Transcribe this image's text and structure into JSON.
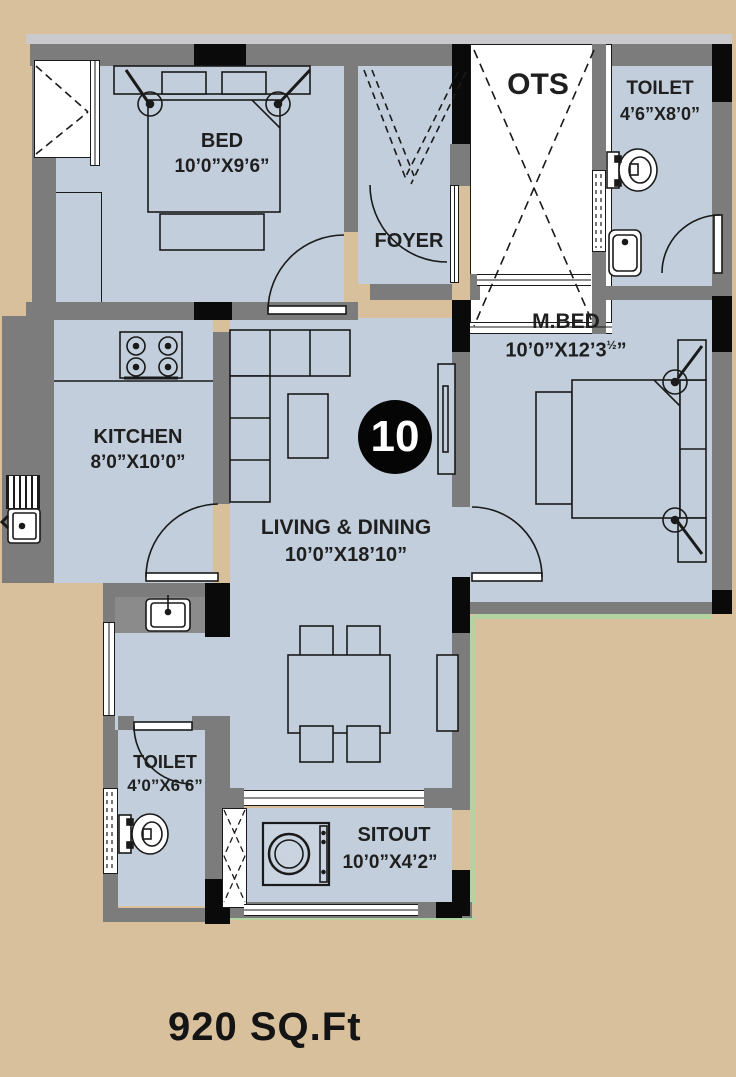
{
  "plan": {
    "unit_number": "10",
    "area_label": "920 SQ.Ft",
    "rooms": {
      "bed": {
        "name": "BED",
        "dim": "10’0”X9’6”"
      },
      "foyer": {
        "name": "FOYER"
      },
      "ots": {
        "name": "OTS"
      },
      "toilet_top": {
        "name": "TOILET",
        "dim": "4’6”X8’0”"
      },
      "master_bed": {
        "name": "M.BED",
        "dim_main": "10’0”X12’3",
        "dim_frac": "½",
        "dim_suffix": "”"
      },
      "kitchen": {
        "name": "KITCHEN",
        "dim": "8’0”X10’0”"
      },
      "living_dining": {
        "name": "LIVING & DINING",
        "dim": "10’0”X18’10”"
      },
      "toilet_bottom": {
        "name": "TOILET",
        "dim": "4’0”X6’6”"
      },
      "sitout": {
        "name": "SITOUT",
        "dim": "10’0”X4’2”"
      }
    },
    "fixtures": [
      "double-bed",
      "master-bed",
      "wardrobe",
      "tv-unit",
      "sofa-l-shape",
      "coffee-table",
      "dining-table-4-chairs",
      "stove-4-burner",
      "kitchen-sink",
      "wash-basin",
      "wc-toilet-top",
      "wc-toilet-bottom",
      "washbasin-toilet-top",
      "washing-machine",
      "entrance-door",
      "ots-shaft",
      "ventilators",
      "windows"
    ],
    "colors": {
      "background": "#d9c09d",
      "room_fill": "#c2cedb",
      "wall": "#7c7c7c",
      "accent_black": "#0a0a0a",
      "garden_green": "#b5d3a2",
      "top_strip": "#c9c9ce"
    }
  }
}
